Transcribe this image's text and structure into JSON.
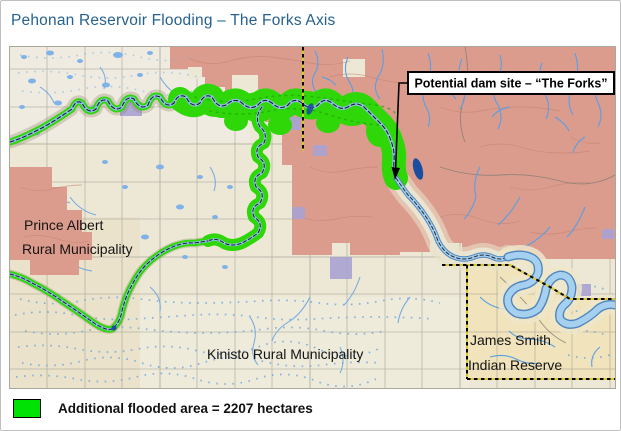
{
  "page_title": "Pehonan Reservoir Flooding – The Forks Axis",
  "map": {
    "labels": {
      "prince_albert_1": "Prince Albert",
      "prince_albert_2": "Rural Municipality",
      "kinisto": "Kinisto Rural Municipality",
      "james_smith_1": "James Smith",
      "james_smith_2": "Indian Reserve"
    },
    "annotation": "Potential dam site – “The Forks”"
  },
  "legend": {
    "label": "Additional flooded area = 2207 hectares",
    "swatch_color": "#00E104"
  },
  "colors": {
    "title_blue": "#26618F",
    "flood_green": "#2FD608",
    "upland_pink": "#DC9C8D",
    "lowland_cream": "#EDE8D6",
    "reserve_tan": "#F1E3BC",
    "stream_blue": "#55A0E6",
    "boundary_yellow": "#D8C830"
  }
}
